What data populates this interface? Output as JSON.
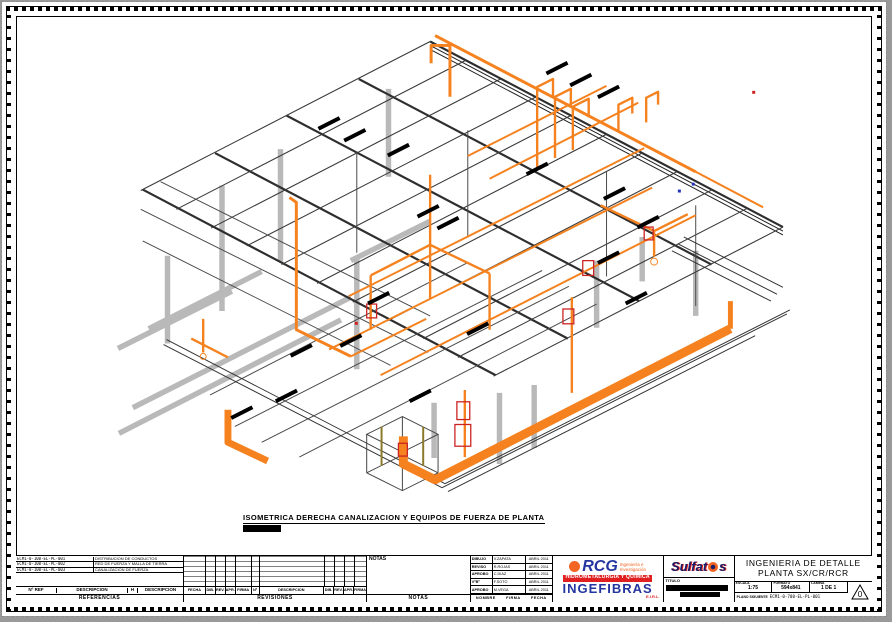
{
  "colors": {
    "orange": "#f5821f",
    "steel": "#b9b9b9",
    "dark": "#3a3a3a",
    "red": "#cc2222",
    "logo-blue": "#24359f",
    "logo-red": "#e02020",
    "logo-orange": "#f26522",
    "client-navy": "#1b1b66"
  },
  "drawing": {
    "caption": "ISOMETRICA DERECHA CANALIZACION Y EQUIPOS DE FUERZA DE PLANTA"
  },
  "titleblock": {
    "references": {
      "rows": [
        {
          "code": "ECM1-0-100-EL-PL-001",
          "desc": "DISTRIBUCION DE CONDUCTOS"
        },
        {
          "code": "ECM1-0-100-EL-PL-002",
          "desc": "RED DE FUERZA Y MALLA DE TIERRA"
        },
        {
          "code": "ECM1-0-100-EL-PL-003",
          "desc": "CANALIZACION DE FUERZA"
        }
      ],
      "col_ref": "Nº REF",
      "col_desc": "DESCRIPCION",
      "col_h": "H",
      "col_desc2": "DESCRIPCION",
      "band": "REFERENCIAS"
    },
    "revisions": {
      "headers": [
        "FECHA",
        "DIB.",
        "REV.",
        "APR.",
        "FIRMA",
        "Nº",
        "DESCRIPCION",
        "DIB.",
        "REV.",
        "APR.",
        "FIRMA"
      ],
      "band": "REVISIONES"
    },
    "notes": {
      "label": "NOTAS",
      "band": "NOTAS"
    },
    "signoff": {
      "rows": [
        {
          "role": "DIBUJO",
          "name": "V.ZAPATA",
          "date": "ABRIL 2011"
        },
        {
          "role": "REVISO",
          "name": "R.ROJAS",
          "date": "ABRIL 2011"
        },
        {
          "role": "APROBO",
          "name": "C.DIAZ",
          "date": "ABRIL 2011"
        },
        {
          "role": "VºBº",
          "name": "F.SOTO",
          "date": "ABRIL 2011"
        },
        {
          "role": "APROBO",
          "name": "M.VEGA",
          "date": "ABRIL 2011"
        }
      ],
      "footer": {
        "c1": "NOMBRE",
        "c2": "FIRMA",
        "c3": "FECHA"
      }
    },
    "contractor": {
      "name": "RCG",
      "tag1": "Ingeniería e",
      "tag2": "Investigación",
      "band": "HIDROMETALURGIA Y QUÍMICA",
      "name2": "INGEFIBRAS",
      "suffix": "E.I.R.L."
    },
    "client": {
      "name_pre": "Sulfat",
      "name_post": "s"
    },
    "project": {
      "line1": "INGENIERIA DE DETALLE",
      "line2": "PLANTA SX/CR/RCR"
    },
    "fields": {
      "titulo": "TITULO",
      "escala_label": "ESCALA",
      "escala": "1:75",
      "formato_label": "FORMATO",
      "formato": "594x841",
      "lamina_label": "LAMINA",
      "lamina": "1 DE 1",
      "revision_label": "REV.",
      "revision": "0",
      "next_label": "PLANO SIGUIENTE",
      "next": "ECM1-0-700-EL-PL-001"
    }
  }
}
